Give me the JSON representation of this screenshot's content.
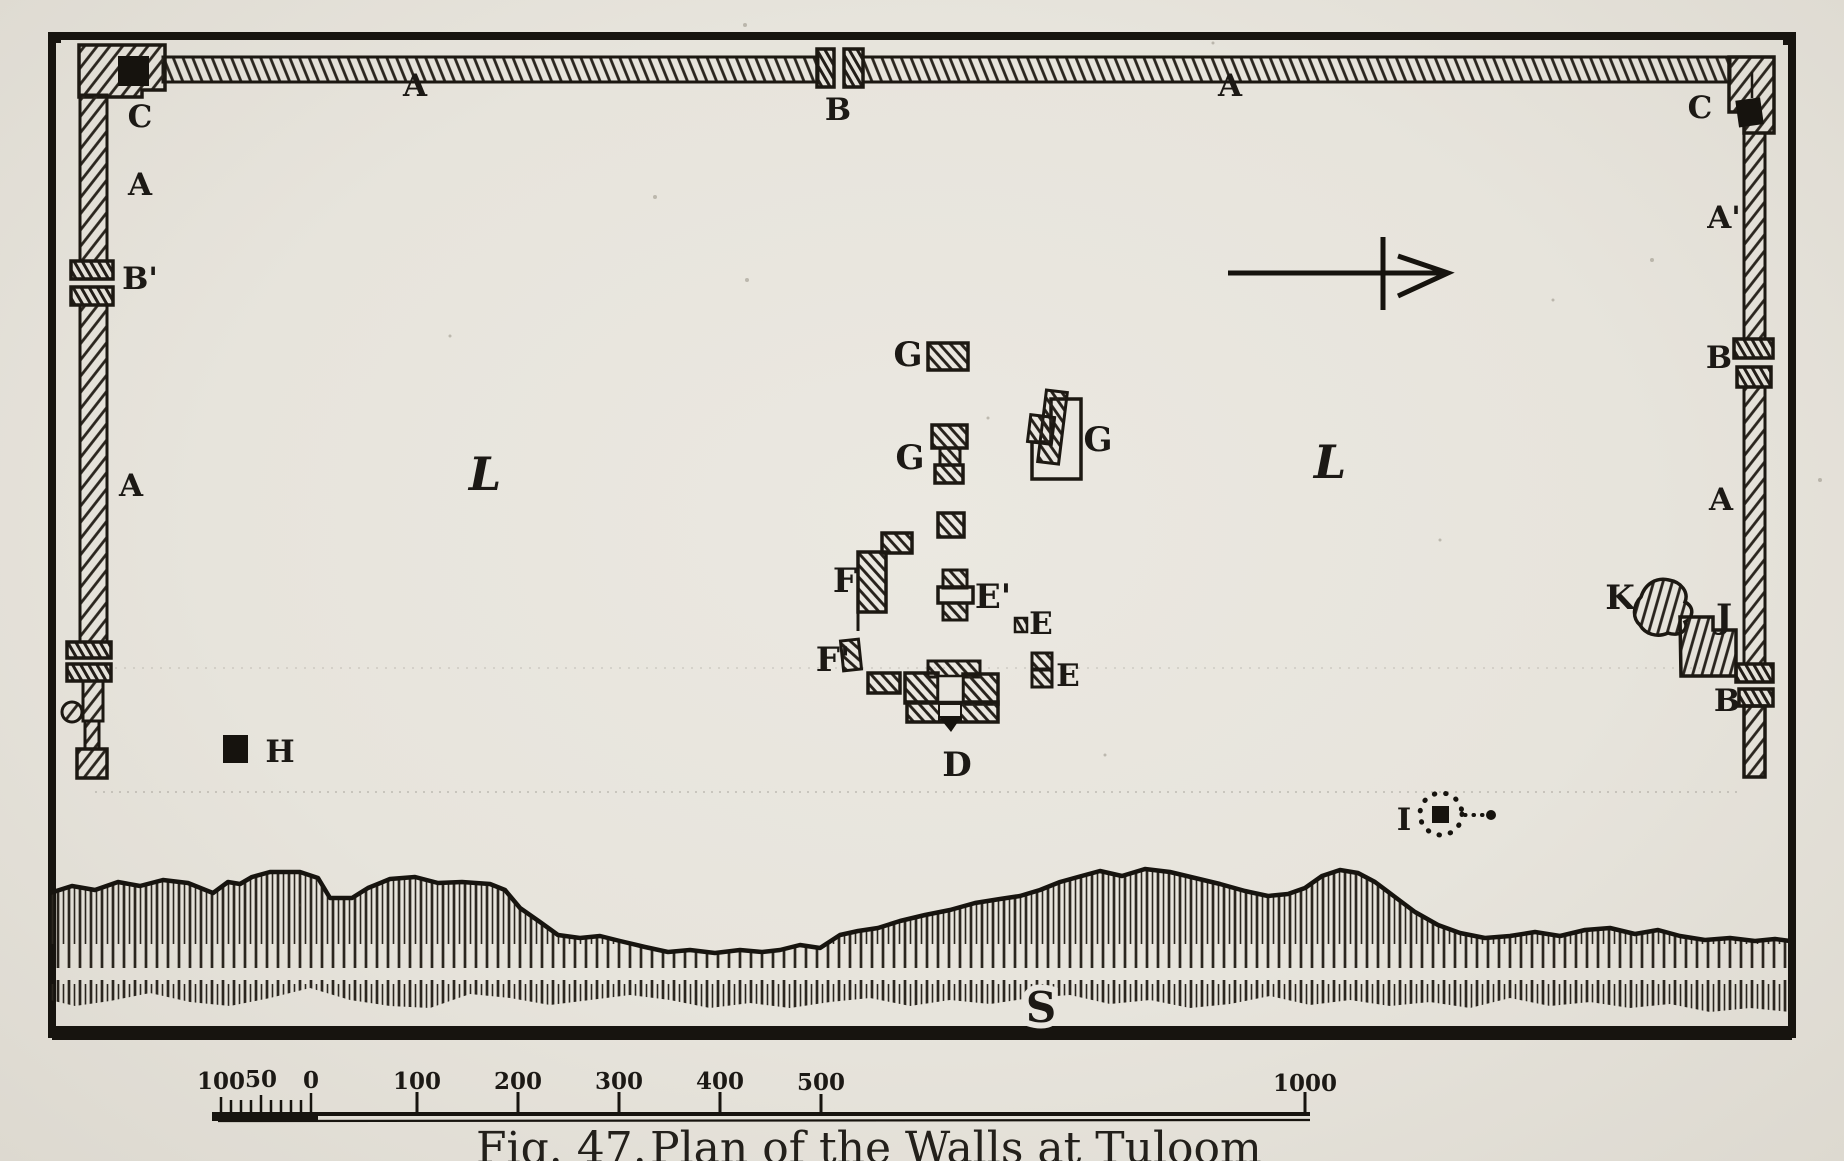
{
  "figure": {
    "number": "Fig. 47.",
    "title": "Plan of the Walls at Tuloom"
  },
  "plan": {
    "wall_labels": {
      "corner_c_left": "C",
      "top_wall_a_left": "A",
      "top_gate_b": "B",
      "top_wall_a_right": "A",
      "corner_c_right": "C",
      "left_wall_a_upper": "A",
      "left_gate_b": "B'",
      "left_wall_a_lower": "A",
      "right_wall_a_upper": "A'",
      "right_gate_b_upper": "B",
      "right_wall_a_lower": "A",
      "right_gate_b_lower": "B"
    },
    "structure_labels": {
      "g_north": "G",
      "g_center": "G",
      "g_east": "G",
      "e_prime": "E'",
      "e_point": "E",
      "e_south": "E",
      "f_north": "F",
      "f_south": "F'",
      "d": "D",
      "h": "H",
      "i": "I",
      "j": "J",
      "k": "K",
      "l_west": "L",
      "l_east": "L",
      "s": "S"
    }
  },
  "scale_bar": {
    "sub_labels": [
      "100",
      "50",
      "0"
    ],
    "major_labels": [
      "100",
      "200",
      "300",
      "400",
      "500"
    ],
    "end_label": "1000"
  }
}
